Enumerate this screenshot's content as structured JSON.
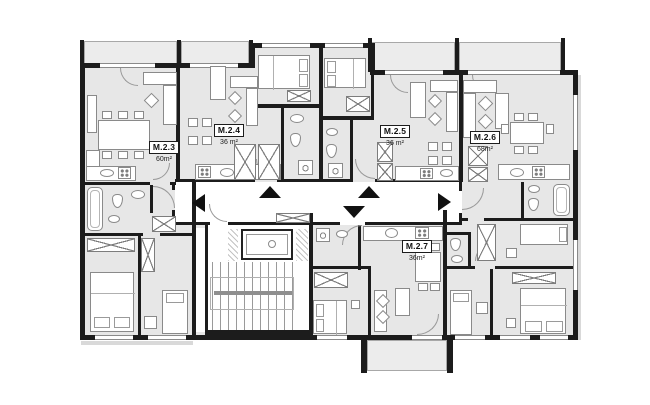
{
  "floor_plan": {
    "title": "apartment-floor-plan",
    "apartments": [
      {
        "id": "M.2.3",
        "area": "60m²"
      },
      {
        "id": "M.2.4",
        "area": "36 m²"
      },
      {
        "id": "M.2.5",
        "area": "36 m²"
      },
      {
        "id": "M.2.6",
        "area": "68m²"
      },
      {
        "id": "M.2.7",
        "area": "36m²"
      }
    ],
    "entrance_arrows": [
      {
        "apartment": "M.2.3",
        "direction": "left"
      },
      {
        "apartment": "M.2.4",
        "direction": "up"
      },
      {
        "apartment": "M.2.5",
        "direction": "up"
      },
      {
        "apartment": "M.2.7",
        "direction": "down"
      },
      {
        "apartment": "M.2.6",
        "direction": "right"
      }
    ],
    "core": {
      "staircase": "staircase",
      "elevator": "elevator"
    },
    "colors": {
      "wall": "#1c1c1c",
      "room_fill": "#e7e7e7",
      "corridor_fill": "#ffffff",
      "balcony_fill": "#ececec",
      "furniture_stroke": "#8a8a8a",
      "arrow": "#111111"
    }
  }
}
